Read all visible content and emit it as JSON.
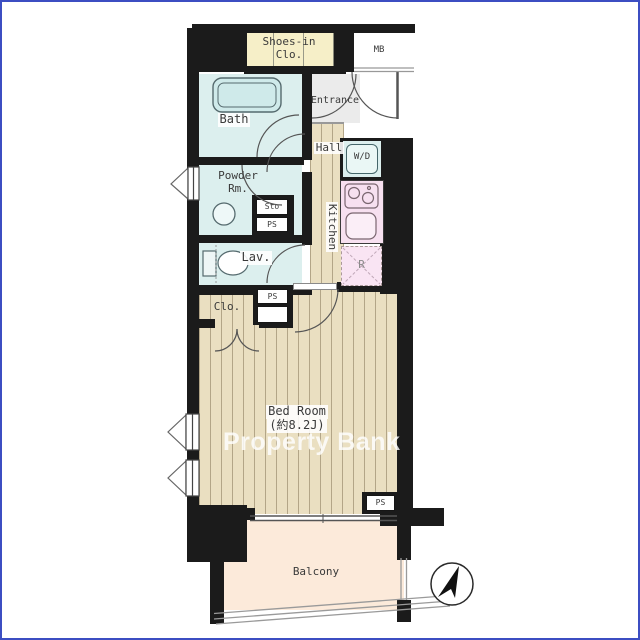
{
  "plan": {
    "type": "apartment-floor-plan",
    "watermark": "Property Bank"
  },
  "labels": {
    "shoes_closet_1": "Shoes-in",
    "shoes_closet_2": "Clo.",
    "meter_box": "MB",
    "bath": "Bath",
    "entrance": "Entrance",
    "hall": "Hall",
    "powder_1": "Powder",
    "powder_2": "Rm.",
    "kitchen": "Kitchen",
    "washer_dryer": "W/D",
    "storage": "Sto",
    "pipe_space_1": "PS",
    "pipe_space_2": "PS",
    "pipe_space_3": "PS",
    "lavatory": "Lav.",
    "refrigerator": "R",
    "closet": "Clo.",
    "bedroom_name": "Bed Room",
    "bedroom_size": "(約8.2J)",
    "balcony": "Balcony"
  },
  "colors": {
    "wall": "#1b1b1b",
    "wet_room_fill": "#dcefee",
    "closet_cream": "#f6efc8",
    "wood_floor": "#eadfc1",
    "entrance_gray": "#ebebeb",
    "kitchen_pink": "#f7e0f0",
    "balcony_peach": "#fceada",
    "frame_blue": "#3c4ec2",
    "watermark": "rgba(255,255,255,0.82)"
  }
}
